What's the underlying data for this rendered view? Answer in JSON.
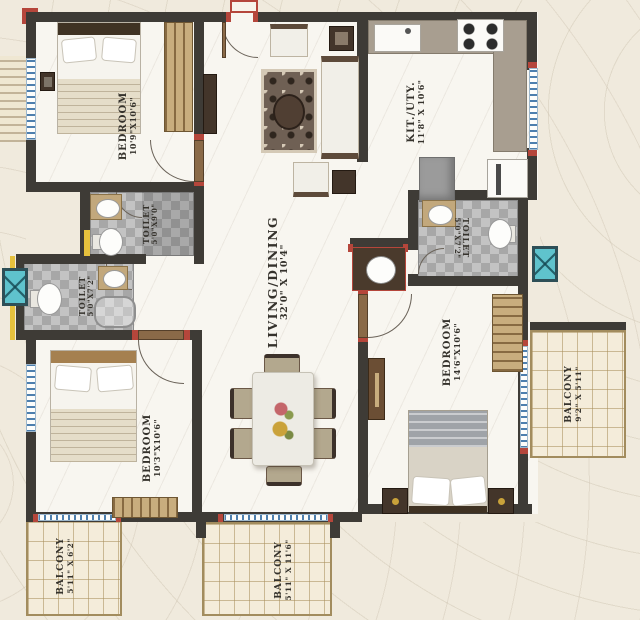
{
  "plan_title": "apartment-floor-plan",
  "rooms": {
    "bedroom_top_left": {
      "name": "BEDROOM",
      "dims": "10'9\"X10'6\""
    },
    "kitchen": {
      "name": "KIT./UTY.",
      "dims": "11'8\" X 10'6\""
    },
    "living_dining": {
      "name": "LIVING/DINING",
      "dims": "32'0\" X 10'4\""
    },
    "toilet_top": {
      "name": "TOILET",
      "dims": "5'0\"X9'0\""
    },
    "toilet_left": {
      "name": "TOILET",
      "dims": "5'0\"X7'2\""
    },
    "toilet_right": {
      "name": "TOILET",
      "dims": "5'0\"X7'2\""
    },
    "bedroom_bottom_left": {
      "name": "BEDROOM",
      "dims": "10'3\"X10'6\""
    },
    "bedroom_right": {
      "name": "BEDROOM",
      "dims": "14'6\"X10'6\""
    },
    "balcony_left": {
      "name": "BALCONY",
      "dims": "5'11\" X 6'2\""
    },
    "balcony_center": {
      "name": "BALCONY",
      "dims": "5'11\" X 11'6\""
    },
    "balcony_right": {
      "name": "BALCONY",
      "dims": "9'2\" X 5'11\""
    }
  },
  "palette": {
    "wall": "#3e3b36",
    "accent_red": "#b5463b",
    "accent_yellow": "#e6c13d",
    "planter_teal": "#5fc3cd",
    "counter_taupe": "#a89e90",
    "balcony_tile": "#f4ecda",
    "toilet_tile": "#b4b4b4",
    "background": "#f0eadd"
  }
}
